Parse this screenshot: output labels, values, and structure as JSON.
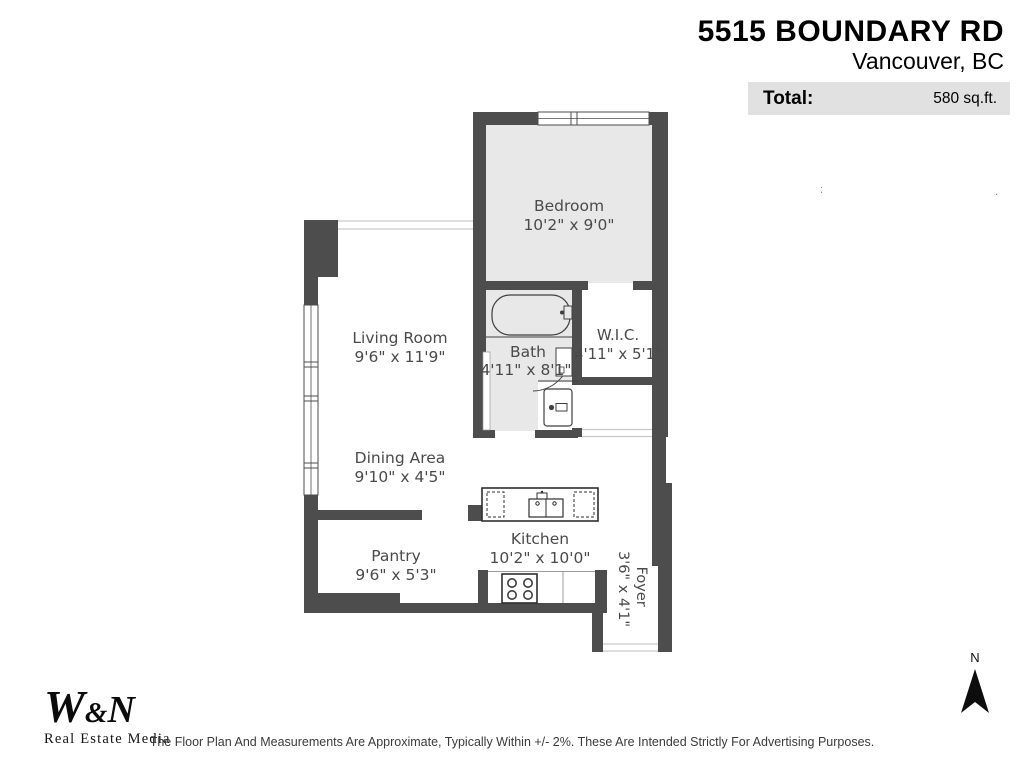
{
  "header": {
    "address_line1": "5515 BOUNDARY RD",
    "address_line2": "Vancouver, BC",
    "total_label": "Total:",
    "total_value": "580 sq.ft."
  },
  "rooms": {
    "bedroom": {
      "name": "Bedroom",
      "dims": "10'2\" x 9'0\""
    },
    "living": {
      "name": "Living Room",
      "dims": "9'6\" x 11'9\""
    },
    "bath": {
      "name": "Bath",
      "dims": "4'11\" x 8'1\""
    },
    "wic": {
      "name": "W.I.C.",
      "dims": "4'11\" x 5'1\""
    },
    "dining": {
      "name": "Dining Area",
      "dims": "9'10\" x 4'5\""
    },
    "pantry": {
      "name": "Pantry",
      "dims": "9'6\" x 5'3\""
    },
    "kitchen": {
      "name": "Kitchen",
      "dims": "10'2\" x 10'0\""
    },
    "foyer": {
      "name": "Foyer",
      "dims": "3'6\" x 4'1\""
    }
  },
  "fixtures": [
    "bathtub",
    "bath-door",
    "washer-dryer",
    "kitchen-sink-island",
    "stove",
    "windows"
  ],
  "footer": {
    "logo_w": "W",
    "logo_amp": "&",
    "logo_n": "N",
    "logo_sub": "Real Estate Media",
    "disclaimer": "The Floor Plan And Measurements Are Approximate, Typically Within +/- 2%. These Are Intended Strictly For Advertising Purposes.",
    "compass_label": "N"
  },
  "artifacts": {
    "colon": ":",
    "dot": "."
  },
  "colors": {
    "wall": "#4d4d4d",
    "room_fill_gray": "#e8e8e8",
    "total_bar_bg": "#e1e1e1",
    "label_text": "#4a4a4a"
  }
}
